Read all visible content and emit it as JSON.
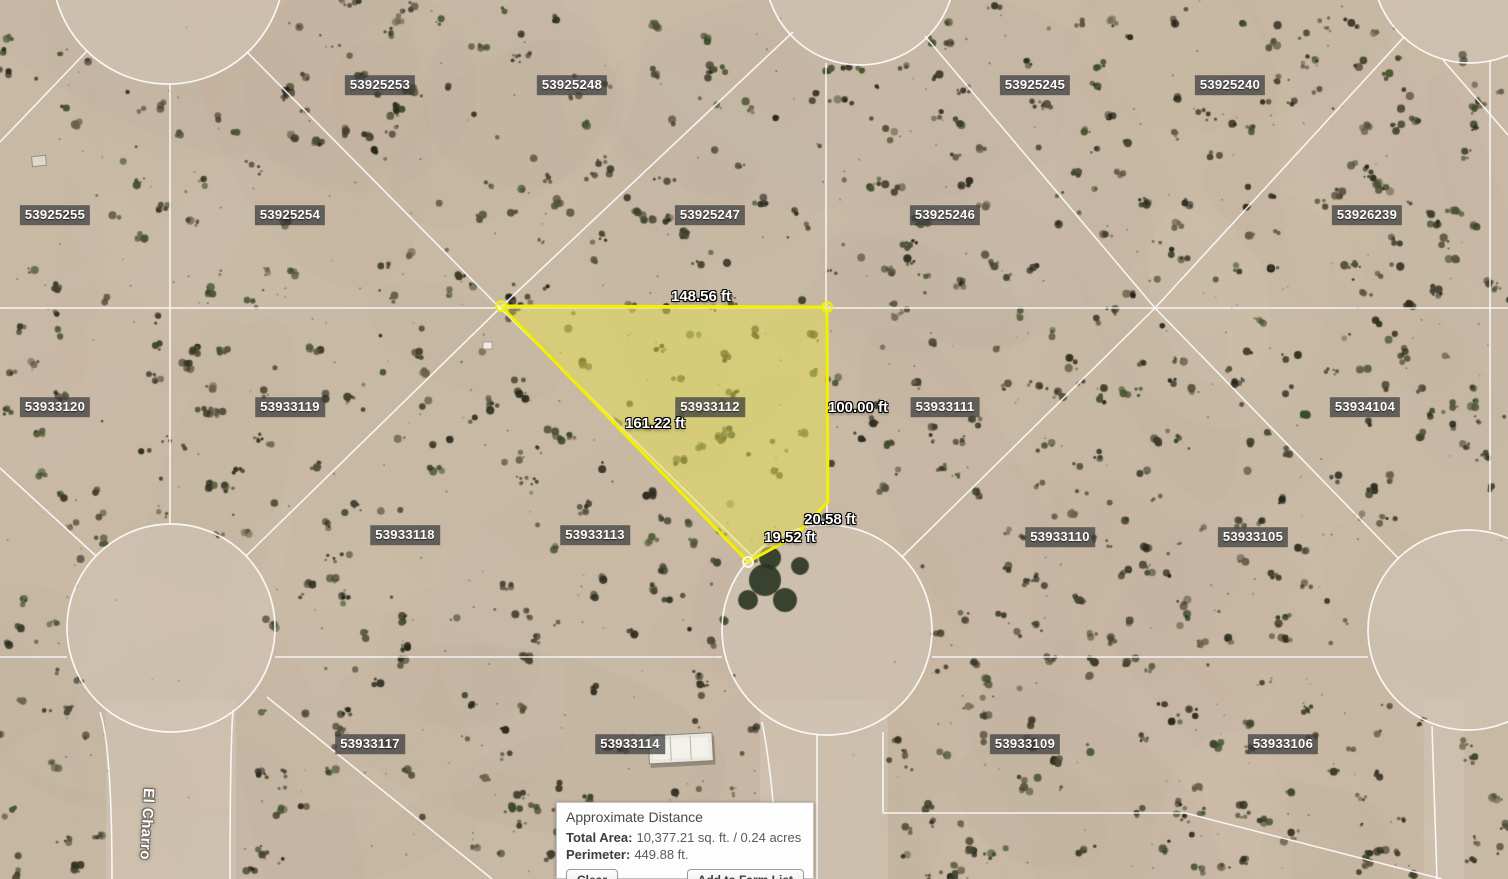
{
  "map": {
    "street_label": "El Charro",
    "selected_parcel_id": "53933112",
    "parcels": [
      {
        "id": "53925253",
        "x": 380,
        "y": 85
      },
      {
        "id": "53925248",
        "x": 572,
        "y": 85
      },
      {
        "id": "53925245",
        "x": 1035,
        "y": 85
      },
      {
        "id": "53925240",
        "x": 1230,
        "y": 85
      },
      {
        "id": "53925255",
        "x": 55,
        "y": 215
      },
      {
        "id": "53925254",
        "x": 290,
        "y": 215
      },
      {
        "id": "53925247",
        "x": 710,
        "y": 215
      },
      {
        "id": "53925246",
        "x": 945,
        "y": 215
      },
      {
        "id": "53926239",
        "x": 1367,
        "y": 215
      },
      {
        "id": "53933120",
        "x": 55,
        "y": 407
      },
      {
        "id": "53933119",
        "x": 290,
        "y": 407
      },
      {
        "id": "53933112",
        "x": 710,
        "y": 407
      },
      {
        "id": "53933111",
        "x": 945,
        "y": 407
      },
      {
        "id": "53934104",
        "x": 1365,
        "y": 407
      },
      {
        "id": "53933118",
        "x": 405,
        "y": 535
      },
      {
        "id": "53933113",
        "x": 595,
        "y": 535
      },
      {
        "id": "53933110",
        "x": 1060,
        "y": 537
      },
      {
        "id": "53933105",
        "x": 1253,
        "y": 537
      },
      {
        "id": "53933117",
        "x": 370,
        "y": 744
      },
      {
        "id": "53933114",
        "x": 630,
        "y": 744
      },
      {
        "id": "53933109",
        "x": 1025,
        "y": 744
      },
      {
        "id": "53933106",
        "x": 1283,
        "y": 744
      }
    ],
    "measurements": [
      {
        "text": "148.56 ft",
        "x": 701,
        "y": 297
      },
      {
        "text": "100.00 ft",
        "x": 858,
        "y": 408
      },
      {
        "text": "161.22 ft",
        "x": 655,
        "y": 424
      },
      {
        "text": "20.58 ft",
        "x": 830,
        "y": 520
      },
      {
        "text": "19.52 ft",
        "x": 790,
        "y": 538
      }
    ]
  },
  "info_panel": {
    "title": "Approximate Distance",
    "total_area_label": "Total Area:",
    "total_area_value": "10,377.21 sq. ft. / 0.24 acres",
    "perimeter_label": "Perimeter:",
    "perimeter_value": "449.88 ft.",
    "clear_button": "Clear",
    "add_button": "Add to Farm List"
  },
  "colors": {
    "selection_stroke": "#f2ef00",
    "selection_fill": "rgba(227,224,79,0.5)",
    "lot_line": "#ffffff",
    "label_box": "rgba(62,62,62,0.74)"
  }
}
